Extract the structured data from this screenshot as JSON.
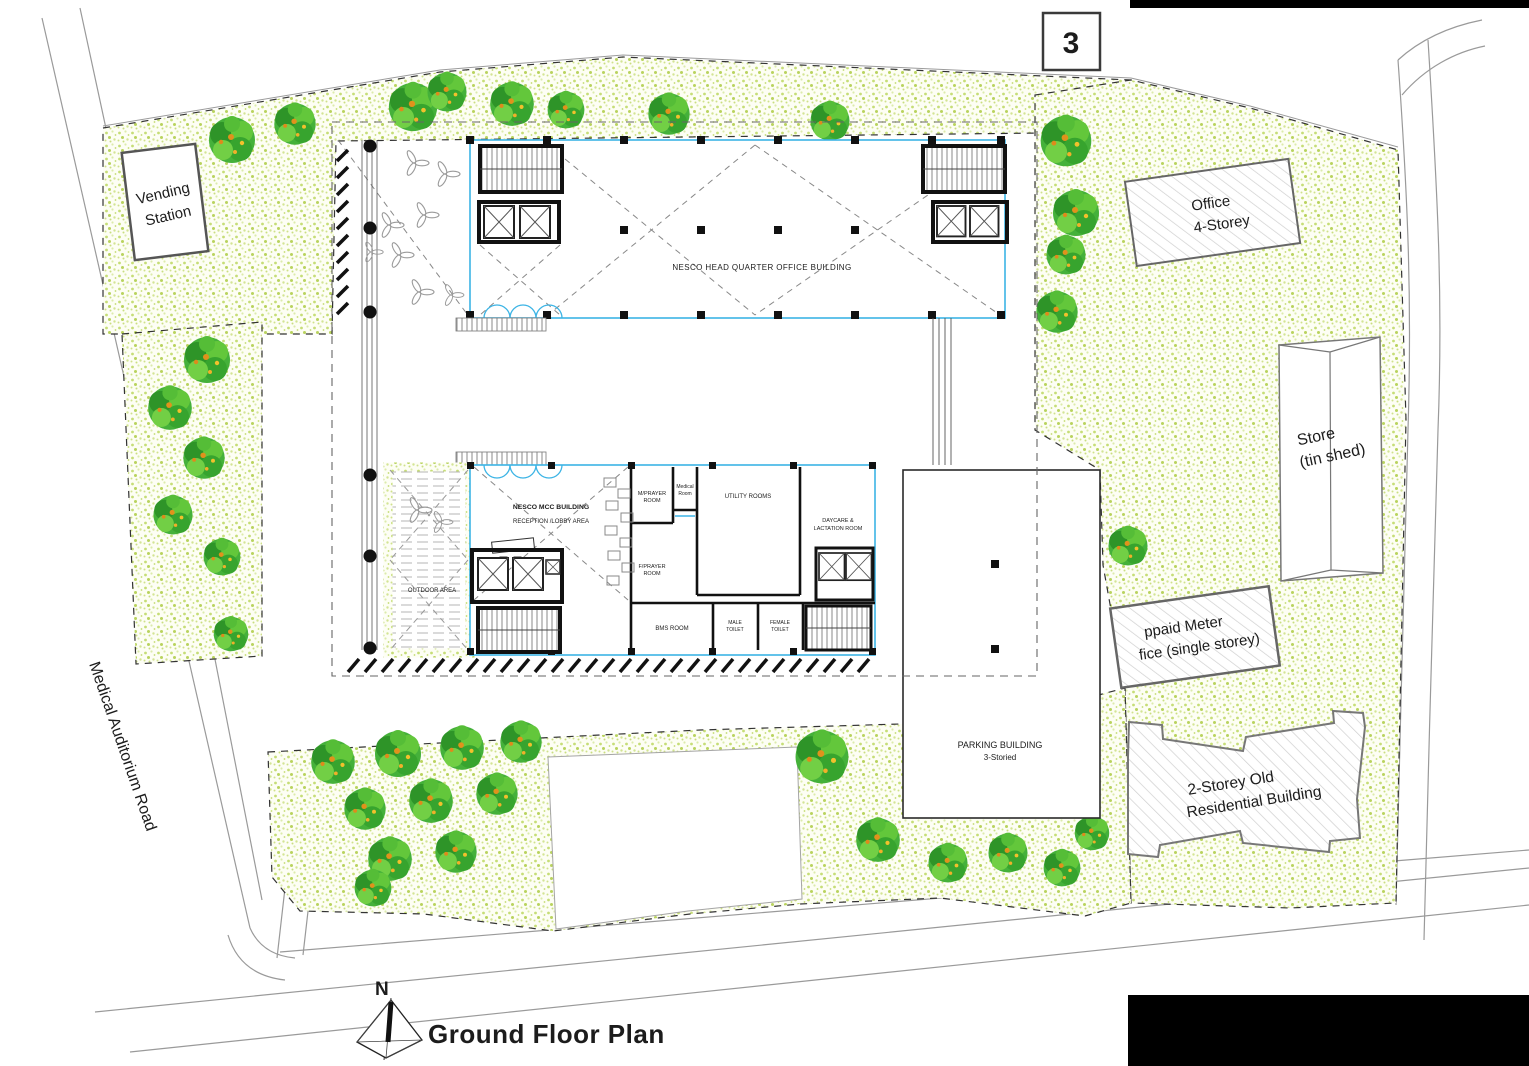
{
  "page": {
    "number_badge": "3"
  },
  "title": {
    "plan_title": "Ground Floor Plan",
    "north_label": "N"
  },
  "roads": {
    "left_road_label": "Medical Auditorium Road"
  },
  "site": {
    "vending": {
      "line1": "Vending",
      "line2": "Station"
    },
    "office4": {
      "line1": "Office",
      "line2": "4-Storey"
    },
    "store": {
      "line1": "Store",
      "line2": "(tin shed)"
    },
    "prepaid": {
      "line1": "ppaid Meter",
      "line2": "fice (single storey)"
    },
    "residential": {
      "line1": "2-Storey Old",
      "line2": "Residential Building"
    },
    "parking": {
      "line1": "PARKING BUILDING",
      "line2": "3-Storied"
    }
  },
  "buildings": {
    "hq_label": "NESCO HEAD QUARTER OFFICE BUILDING",
    "mcc": {
      "name": "NESCO MCC BUILDING",
      "reception": "RECEPTION /LOBBY AREA",
      "outdoor": "OUTDOOR AREA",
      "m_prayer": {
        "line1": "M/PRAYER",
        "line2": "ROOM"
      },
      "medical": {
        "line1": "Medical",
        "line2": "Room"
      },
      "utility": "UTILITY ROOMS",
      "f_prayer": {
        "line1": "F/PRAYER",
        "line2": "ROOM"
      },
      "daycare": {
        "line1": "DAYCARE &",
        "line2": "LACTATION ROOM"
      },
      "bms": "BMS ROOM",
      "male_toilet": {
        "line1": "MALE",
        "line2": "TOILET"
      },
      "female_toilet": {
        "line1": "FEMALE",
        "line2": "TOILET"
      }
    }
  },
  "colors": {
    "building_outline_cyan": "#3cb4e5",
    "wall_black": "#111111",
    "greenery_dot": "#b9d35e",
    "tree_green": "#3fae32",
    "tree_accent_orange": "#e8951e",
    "road_gray": "#999999"
  }
}
